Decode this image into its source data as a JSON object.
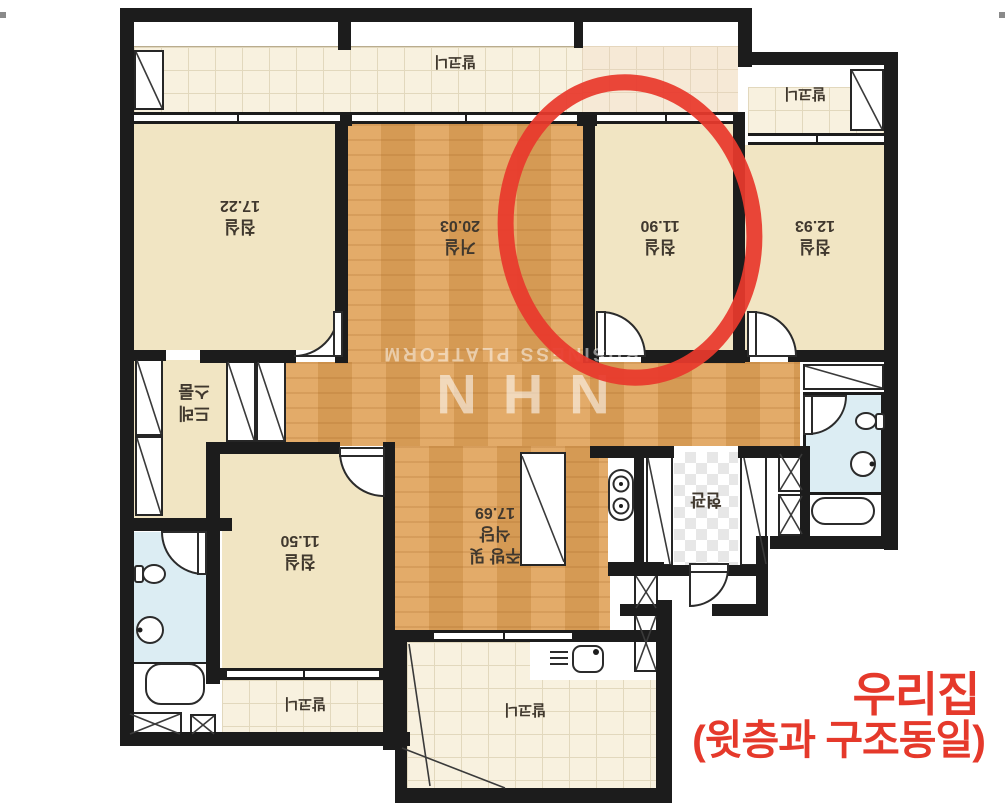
{
  "rooms": {
    "living": {
      "name": "거실",
      "area": "20.03"
    },
    "bedroom_top_left": {
      "name": "침실",
      "area": "17.22"
    },
    "bedroom_circled": {
      "name": "침실",
      "area": "11.90"
    },
    "bedroom_right": {
      "name": "침실",
      "area": "12.93"
    },
    "bedroom_bottom": {
      "name": "침실",
      "area": "11.50"
    },
    "kitchen": {
      "name_line1": "주방 및",
      "name_line2": "식당",
      "area": "17.69"
    },
    "dressroom": {
      "name_line1": "드레",
      "name_line2": "스룸"
    },
    "entrance": {
      "name": "현관"
    },
    "balcony_top": {
      "name": "발코니"
    },
    "balcony_top_right": {
      "name": "발코니"
    },
    "balcony_bottom_left": {
      "name": "발코니"
    },
    "balcony_bottom_center": {
      "name": "발코니"
    }
  },
  "watermark": {
    "brand": "NHN",
    "subtitle": "BUSINESS PLATFORM"
  },
  "annotation": {
    "caption_line1": "우리집",
    "caption_line2": "(윗층과 구조동일)",
    "color": "#e8392c"
  },
  "colors": {
    "wall": "#1c1c1c",
    "wood_floor": "#e0a258",
    "room_cream": "#f1e5c3",
    "balcony_tile": "#f8f1df",
    "bathroom_blue": "#dcedf3",
    "annotation_red": "#e8392c",
    "label_text": "#40382e",
    "watermark_white": "rgba(255,255,255,0.55)"
  }
}
